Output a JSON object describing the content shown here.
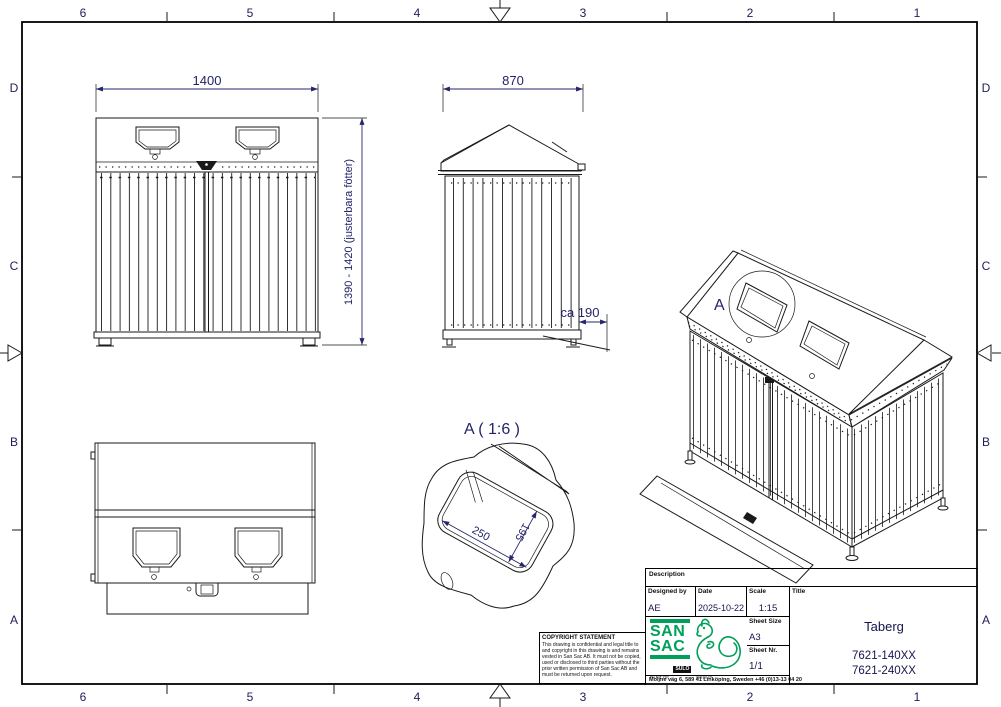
{
  "sheet": {
    "grid": {
      "cols": [
        "6",
        "5",
        "4",
        "3",
        "2",
        "1"
      ],
      "rows": [
        "D",
        "C",
        "B",
        "A"
      ]
    }
  },
  "views": {
    "front": {
      "width_dim": "1400",
      "height_dim": "1390 - 1420 (justerbara fötter)"
    },
    "side": {
      "width_dim": "870",
      "hatch_dim": "ca 190"
    },
    "detail": {
      "title": "A ( 1:6 )",
      "width_dim": "250",
      "height_dim": "195"
    },
    "iso": {
      "detail_callout": "A"
    }
  },
  "title_block": {
    "description_label": "Description",
    "designed_by_label": "Designed by",
    "designed_by": "AE",
    "date_label": "Date",
    "date": "2025-10-22",
    "scale_label": "Scale",
    "scale": "1:15",
    "sheet_size_label": "Sheet Size",
    "sheet_size": "A3",
    "sheet_nr_label": "Sheet Nr.",
    "sheet_nr": "1/1",
    "title_label": "Title",
    "title": "Taberg",
    "part_numbers": [
      "7621-140XX",
      "7621-240XX"
    ],
    "logo": {
      "san": "SAN",
      "sac": "SAC",
      "part_of": "PART OF",
      "sulo": "SULO",
      "group": "GROUP",
      "address": "Moljne väg 6, 589 41 Linköping, Sweden  +46 (0)13-13 04 20"
    }
  },
  "copyright": {
    "heading": "COPYRIGHT STATEMENT",
    "body": "This drawing is confidential and legal title to and copyright in this drawing is and remains vested in San Sac AB. It must not be copied, used or disclosed to third parties without the prior written permission of San Sac AB and must be returned upon request."
  },
  "colors": {
    "brand_green": "#00a05a",
    "dimension_text": "#23236a"
  }
}
